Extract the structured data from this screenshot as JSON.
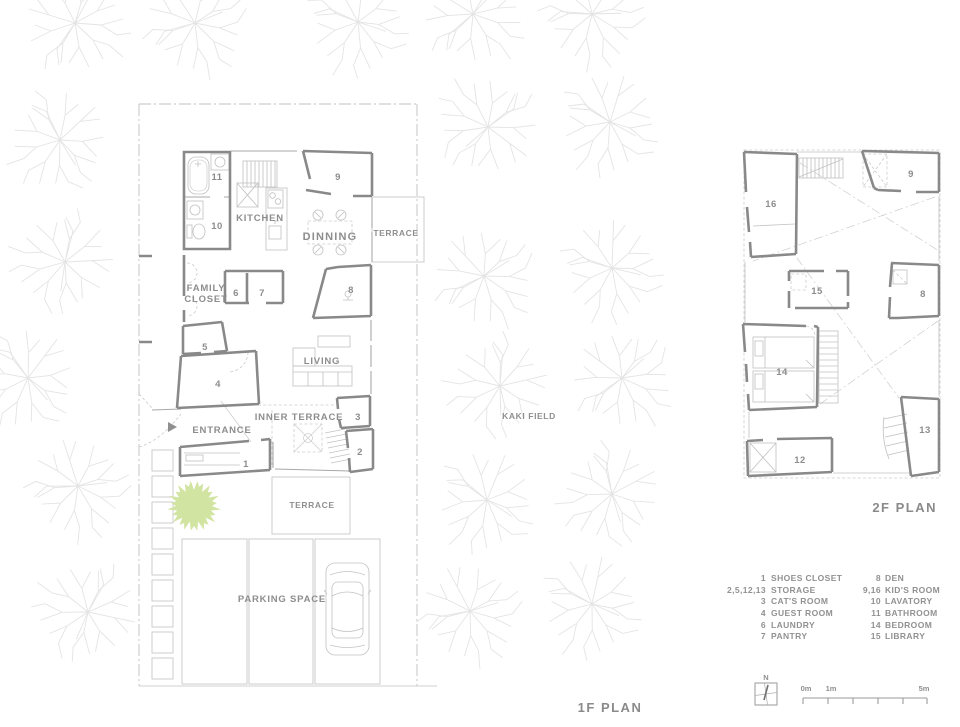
{
  "plan_1f": {
    "title": "1F PLAN",
    "labels": {
      "kitchen": "KITCHEN",
      "dinning": "DINNING",
      "terrace_east": "TERRACE",
      "family_closet_line1": "FAMILY",
      "family_closet_line2": "CLOSET",
      "living": "LIVING",
      "entrance": "ENTRANCE",
      "inner_terrace": "INNER TERRACE",
      "terrace_south": "TERRACE",
      "parking": "PARKING SPACE",
      "kaki_field": "KAKI FIELD"
    },
    "room_numbers": {
      "n1": "1",
      "n2": "2",
      "n3": "3",
      "n4": "4",
      "n5": "5",
      "n6": "6",
      "n7": "7",
      "n8": "8",
      "n9": "9",
      "n10": "10",
      "n11": "11"
    }
  },
  "plan_2f": {
    "title": "2F PLAN",
    "room_numbers": {
      "n8": "8",
      "n9": "9",
      "n12": "12",
      "n13": "13",
      "n14": "14",
      "n15": "15",
      "n16": "16"
    }
  },
  "legend": {
    "left": [
      {
        "num": "1",
        "label": "SHOES CLOSET"
      },
      {
        "num": "2,5,12,13",
        "label": "STORAGE"
      },
      {
        "num": "3",
        "label": "CAT'S ROOM"
      },
      {
        "num": "4",
        "label": "GUEST ROOM"
      },
      {
        "num": "6",
        "label": "LAUNDRY"
      },
      {
        "num": "7",
        "label": "PANTRY"
      }
    ],
    "right": [
      {
        "num": "8",
        "label": "DEN"
      },
      {
        "num": "9,16",
        "label": "KID'S ROOM"
      },
      {
        "num": "10",
        "label": "LAVATORY"
      },
      {
        "num": "11",
        "label": "BATHROOM"
      },
      {
        "num": "14",
        "label": "BEDROOM"
      },
      {
        "num": "15",
        "label": "LIBRARY"
      }
    ]
  },
  "scale_bar": {
    "north_label": "N",
    "tick_0": "0m",
    "tick_1": "1m",
    "tick_5": "5m"
  },
  "colors": {
    "wall": "#898989",
    "light_line": "#c3c3c3",
    "text": "#8d8d8d",
    "tree_green": "#d2e4a2",
    "background": "#ffffff"
  }
}
